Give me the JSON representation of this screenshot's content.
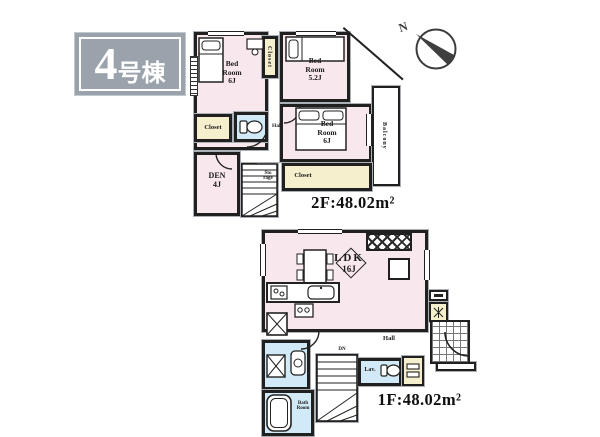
{
  "badge": {
    "number": "4",
    "suffix": "号棟"
  },
  "compass": {
    "north": "N"
  },
  "colors": {
    "room_pink": "#f9e7ee",
    "water_blue": "#d2eaf7",
    "closet_yellow": "#f5efcd",
    "badge_gray": "#9aa3ab",
    "wall_dark": "#202020"
  },
  "floor2": {
    "area": "2F:48.02m²",
    "bedroom_nw": {
      "name": "Bed Room",
      "size": "6J"
    },
    "bedroom_ne": {
      "name": "Bed Room",
      "size": "5.2J"
    },
    "bedroom_se": {
      "name": "Bed Room",
      "size": "6J"
    },
    "closet_top": "Closet",
    "closet_west": "Closet",
    "closet_south": "Closet",
    "storage": "Sto rage",
    "hall": "Hall",
    "den": {
      "name": "DEN",
      "size": "4J"
    },
    "balcony": "Balcony"
  },
  "floor1": {
    "area": "1F:48.02m²",
    "ldk": {
      "name": "LDK",
      "size": "16J"
    },
    "hall": "Hall",
    "stairs_note": "DN",
    "lavatory": "Lav.",
    "bathroom": "Bath Room"
  }
}
